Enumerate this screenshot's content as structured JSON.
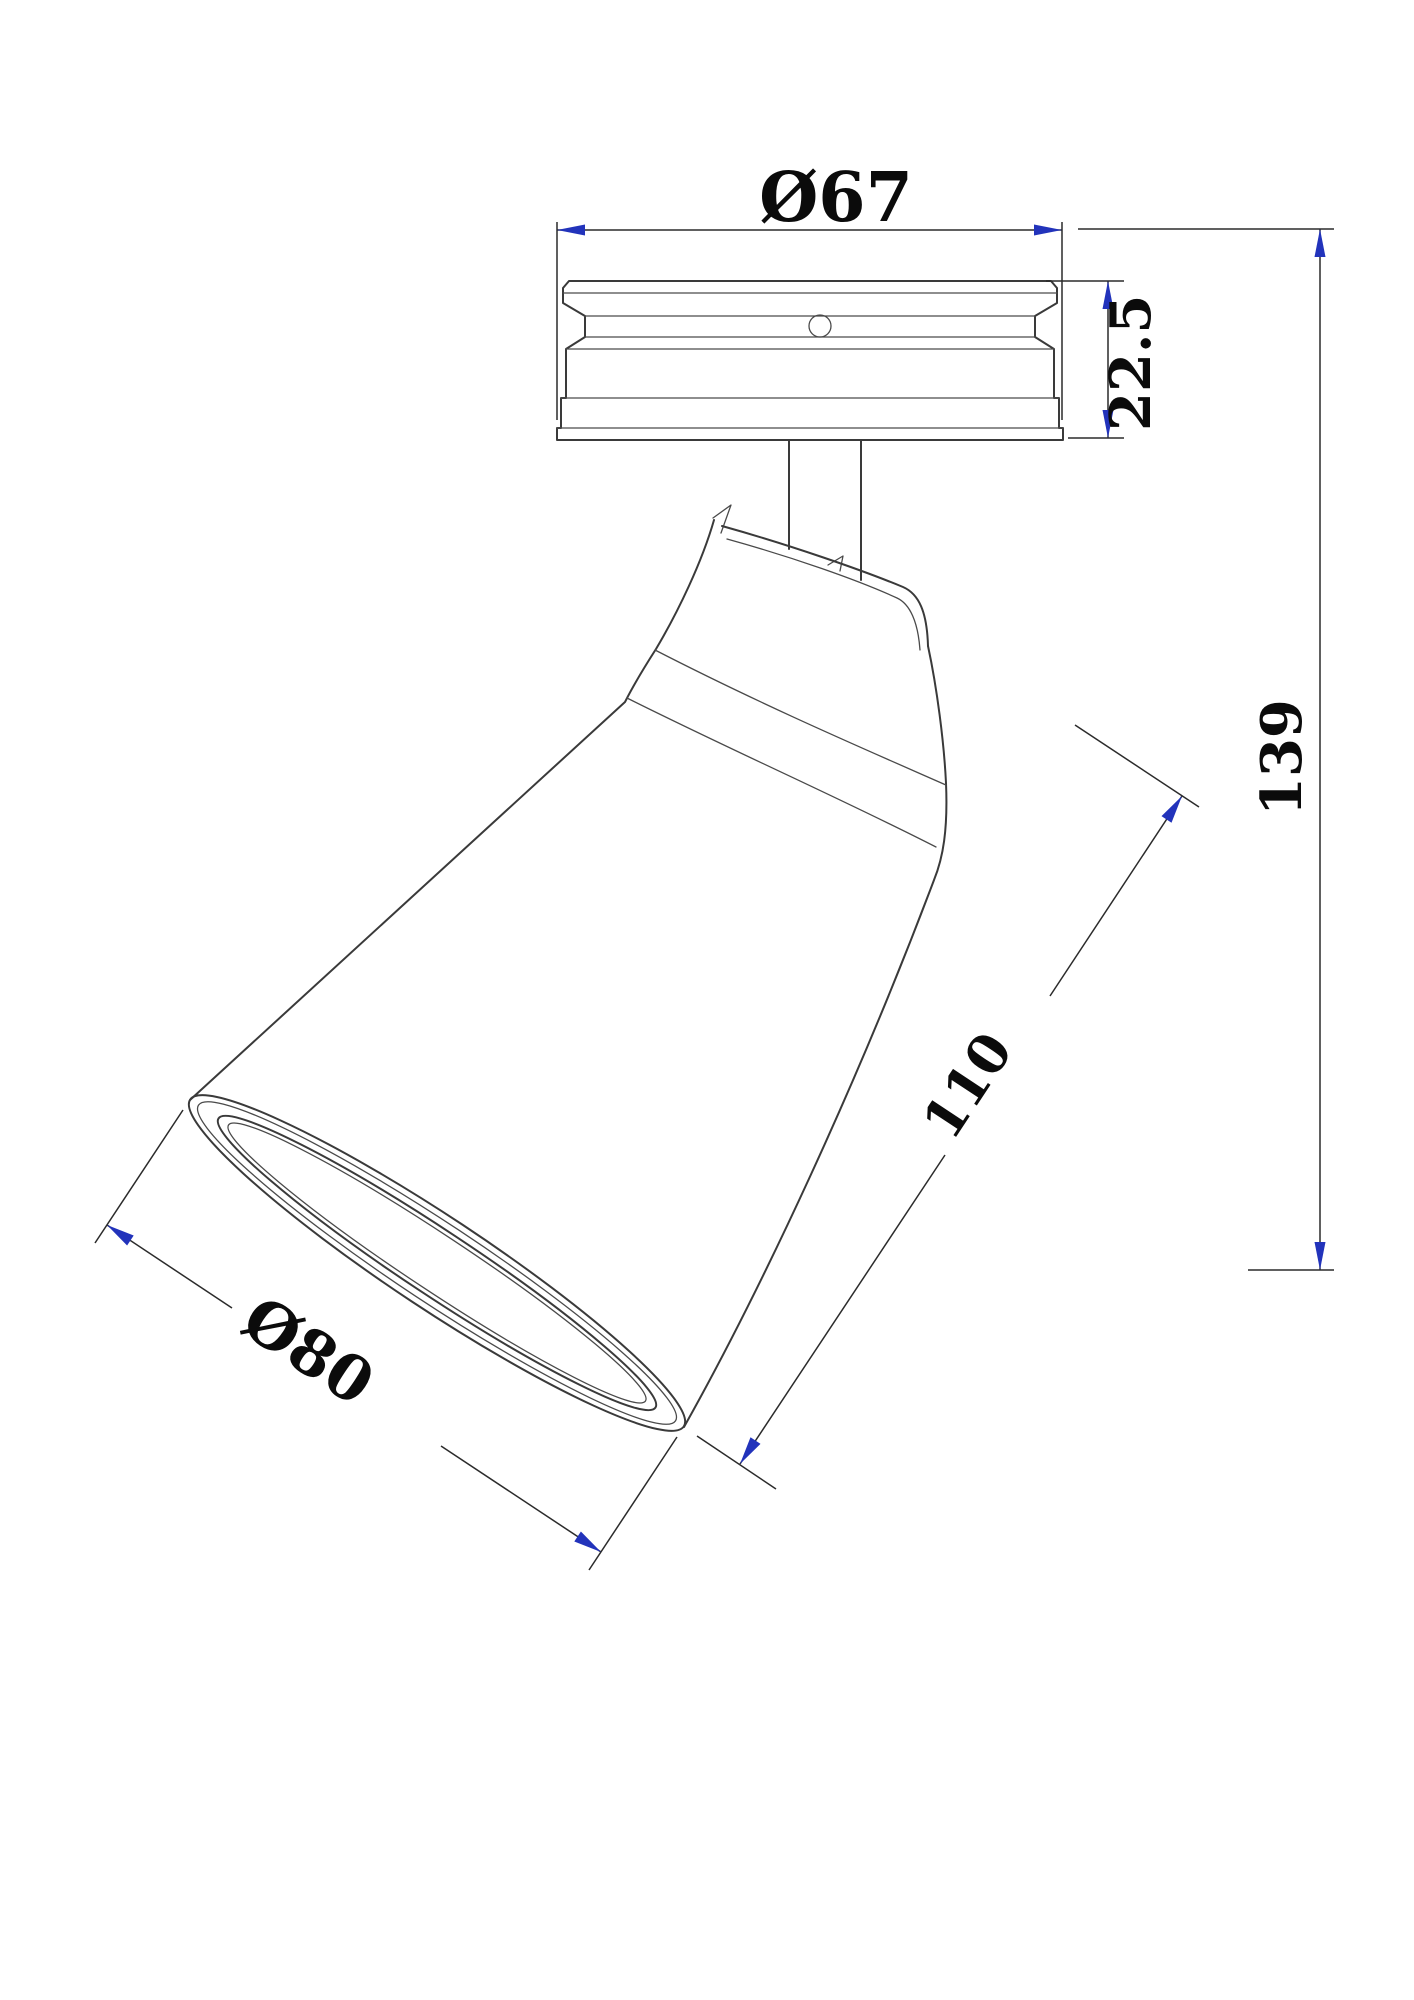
{
  "drawing": {
    "title": "ceiling-spotlight-dimension-drawing",
    "units": "mm"
  },
  "dimensions": {
    "canopy_diameter": "Ø67",
    "canopy_height": "22.5",
    "overall_height": "139",
    "head_length": "110",
    "shade_diameter": "Ø80"
  },
  "colors": {
    "background": "#ffffff",
    "object_line": "#3a3a3a",
    "dimension_line": "#2b2b2b",
    "arrow": "#2233bb",
    "text": "#0b0b0b"
  }
}
